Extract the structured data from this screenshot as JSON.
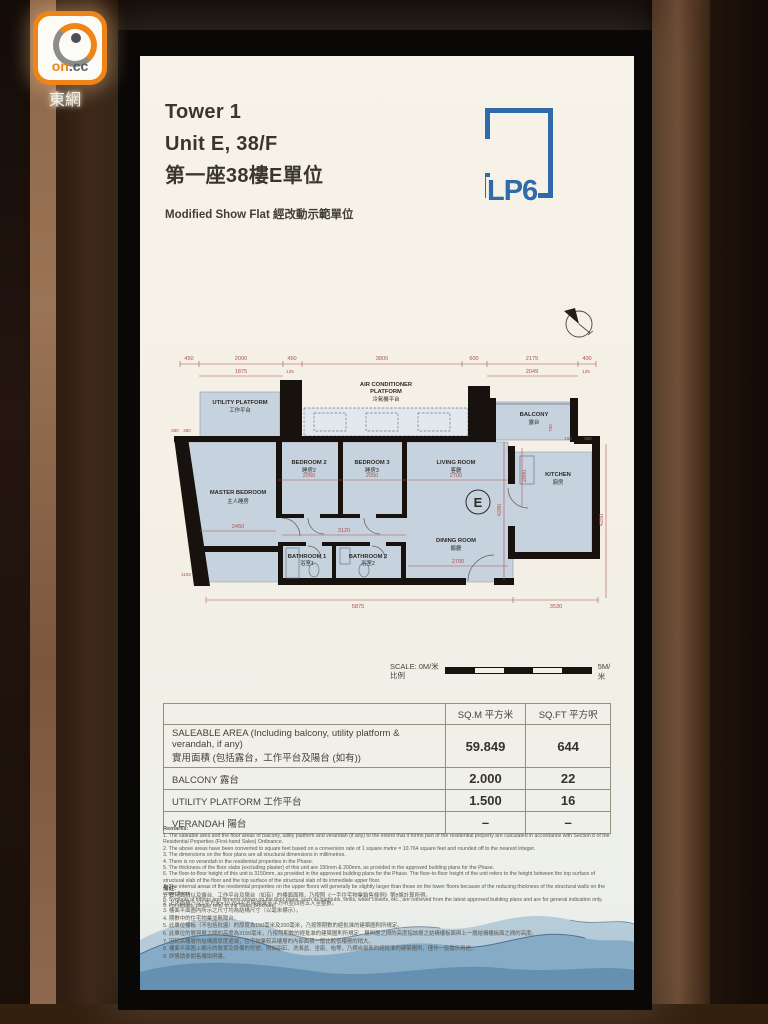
{
  "watermark": {
    "logo_on": "on",
    "logo_cc": ".cc",
    "site_name": "東網"
  },
  "header": {
    "tower": "Tower 1",
    "unit": "Unit E, 38/F",
    "unit_zh": "第一座38樓E單位",
    "subtitle": "Modified Show Flat 經改動示範單位",
    "brand": "LP6",
    "brand_color": "#2f6ba8"
  },
  "floorplan": {
    "unit_badge": "E",
    "rooms": [
      {
        "en": "UTILITY PLATFORM",
        "zh": "工作平台"
      },
      {
        "en": "AIR CONDITIONER",
        "en2": "PLATFORM",
        "zh": "冷氣機平台"
      },
      {
        "en": "BALCONY",
        "zh": "露台"
      },
      {
        "en": "MASTER BEDROOM",
        "zh": "主人睡房"
      },
      {
        "en": "BEDROOM 2",
        "zh": "睡房2"
      },
      {
        "en": "BEDROOM 3",
        "zh": "睡房3"
      },
      {
        "en": "LIVING ROOM",
        "zh": "客廳"
      },
      {
        "en": "KITCHEN",
        "zh": "廚房"
      },
      {
        "en": "DINING ROOM",
        "zh": "飯廳"
      },
      {
        "en": "BATHROOM 1",
        "zh": "浴室1"
      },
      {
        "en": "BATHROOM 2",
        "zh": "浴室2"
      }
    ],
    "dims": [
      "450",
      "2000",
      "450",
      "3800",
      "600",
      "2175",
      "400",
      "1875",
      "2049",
      "125",
      "125",
      "360",
      "380",
      "2050",
      "2050",
      "2700",
      "2450",
      "3120",
      "4280",
      "2880",
      "2700",
      "1192",
      "5875",
      "3530",
      "4250",
      "750",
      "100",
      "360"
    ],
    "dim_color": "#b0514d"
  },
  "scale": {
    "left_label": "SCALE: 0M/米",
    "left_label_zh": "比例",
    "right_label": "5M/米"
  },
  "area_table": {
    "col_sqm": "SQ.M 平方米",
    "col_sqft": "SQ.FT 平方呎",
    "rows": [
      {
        "label": "SALEABLE AREA (Including balcony, utility platform & verandah, if any)",
        "label_zh": "實用面積 (包括露台，工作平台及陽台 (如有))",
        "sqm": "59.849",
        "sqft": "644"
      },
      {
        "label": "BALCONY 露台",
        "sqm": "2.000",
        "sqft": "22"
      },
      {
        "label": "UTILITY PLATFORM 工作平台",
        "sqm": "1.500",
        "sqft": "16"
      },
      {
        "label": "VERANDAH 陽台",
        "sqm": "–",
        "sqft": "–"
      }
    ]
  },
  "remarks": {
    "title": "Remarks:",
    "items": [
      "1. The saleable area and the floor areas of balcony, utility platform and verandah (if any) to the extent that it forms part of the residential property are calculated in accordance with Section 8 of the Residential Properties (First-hand Sales) Ordinance.",
      "2. The above areas have been converted to square feet based on a conversion rate of 1 square metre = 10.764 square feet and rounded off to the nearest integer.",
      "3. The dimensions on the floor plans are all structural dimensions in millimetres.",
      "4. There is no verandah in the residential properties in the Phase.",
      "5. The thickness of the floor slabs (excluding plaster) of this unit are 150mm & 200mm, as provided in the approved building plans for the Phase.",
      "6. The floor-to-floor height of this unit is 3150mm, as provided in the approved building plans for the Phase. The floor-to-floor height of the unit refers to the height between the top surface of structural slab of the floor and the top surface of the structural slab of its immediate upper floor.",
      "7. The internal areas of the residential properties on the upper floors will generally be slightly larger than those on the lower floors because of the reducing thickness of the structural walls on the upper floors.",
      "8. Symbols of fittings and fitments shown on the floor plans, such as bathtubs, sinks, water closets, etc., are retrieved from the latest approved building plans and are for general indication only.",
      "9. For details, please refer to the Sales Brochure."
    ],
    "title_zh": "備註:",
    "items_zh": [
      "1. 實用面積以及露台、工作平台及陽台（如有）的樓面面積，乃按照《一手住宅物業銷售條例》第8條計算所得。",
      "2. 上述面積乃以1平方米=10.764平方呎換算至平方呎並四捨五入至整數。",
      "3. 樓面平面圖內所示之尺寸均為結構尺寸（以毫米標示）。",
      "4. 期數中的住宅物業並無陽台。",
      "5. 此單位樓板（不包括批盪）的厚度為150毫米及200毫米，乃按照期數的經批准的建築圖則所規定。",
      "6. 此單位的層與層之間的高度為3150毫米，乃按照期數的經批准的建築圖則所規定。層與層之間的高度指該層之結構樓板面與上一層結構樓板面之間的高度。",
      "7. 因較高樓層的結構牆厚度遞減，住宅物業較高樓層的內部面積一般比較低樓層的稍大。",
      "8. 樓面平面圖上顯示的裝置及設備的符號，例如浴缸、洗滌盆、坐廁、枱等，乃摘自最新的經批准的建築圖則，僅作一般指示用途。",
      "9. 詳情請參閱售樓說明書。"
    ]
  }
}
